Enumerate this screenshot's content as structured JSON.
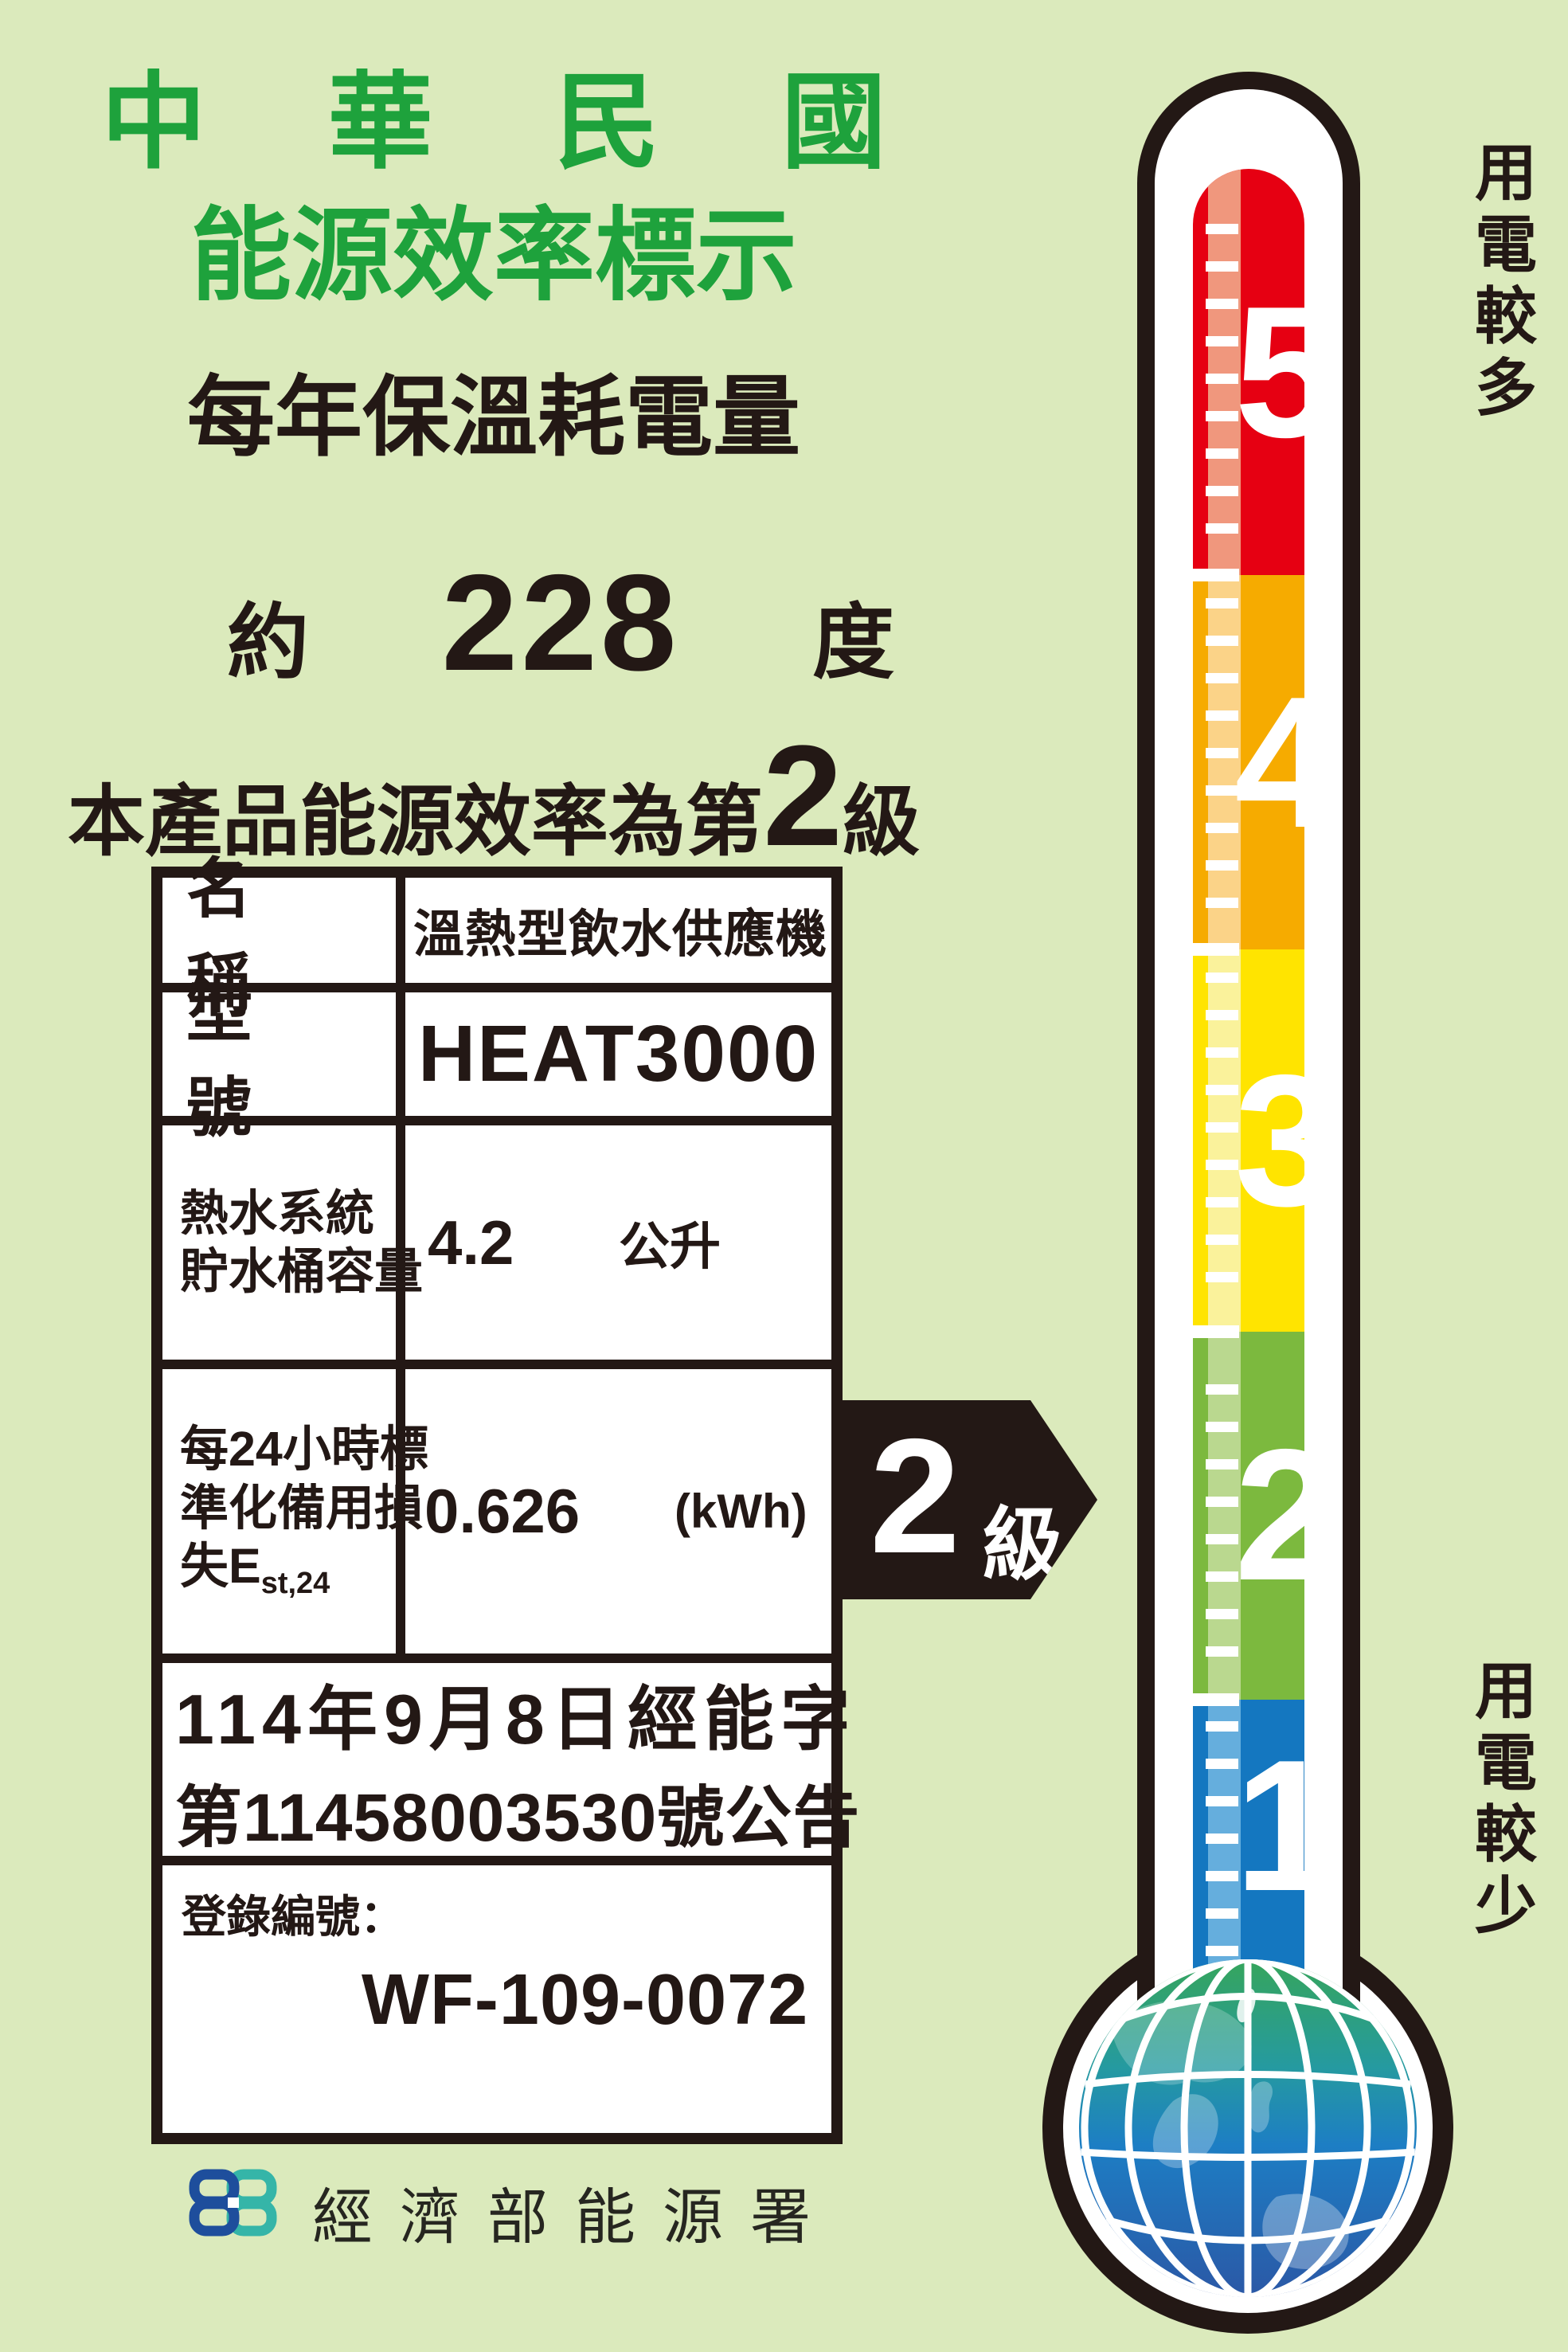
{
  "header": {
    "title_line1": "中 華 民 國",
    "title_line2": "能源效率標示",
    "subtitle": "每年保溫耗電量",
    "consumption_prefix": "約",
    "consumption_value": "228",
    "consumption_unit": "度",
    "rating_prefix": "本產品能源效率為第",
    "rating_value": "2",
    "rating_suffix": "級"
  },
  "table": {
    "rows": [
      {
        "label": "名　稱",
        "value": "溫熱型飲水供應機"
      },
      {
        "label": "型　號",
        "value": "HEAT3000"
      },
      {
        "label_line1": "熱水系統",
        "label_line2": "貯水桶容量",
        "value": "4.2",
        "unit": "公升"
      },
      {
        "label_line1": "每24小時標",
        "label_line2": "準化備用損",
        "label_line3_main": "失E",
        "label_line3_sub": "st,24",
        "value": "0.626",
        "unit": "(kWh)"
      }
    ],
    "announcement_line1": "114年9月8日經能字",
    "announcement_line2": "第11458003530號公告",
    "registration_label": "登錄編號：",
    "registration_value": "WF-109-0072"
  },
  "grade_arrow": {
    "value": "2",
    "suffix": "級"
  },
  "thermometer": {
    "scale_top_label": "用電較多",
    "scale_bottom_label": "用電較少",
    "levels": [
      {
        "value": "5",
        "color": "#e60012",
        "tint": "#f0977d"
      },
      {
        "value": "4",
        "color": "#f6ab00",
        "tint": "#fbd388"
      },
      {
        "value": "3",
        "color": "#ffe400",
        "tint": "#faf29b"
      },
      {
        "value": "2",
        "color": "#7cb93e",
        "tint": "#bad88f"
      },
      {
        "value": "1",
        "color": "#1477c0",
        "tint": "#65aedd"
      }
    ]
  },
  "footer": {
    "agency": "經濟部能源署"
  },
  "colors": {
    "background": "#dbeabc",
    "title_green": "#1ea23c",
    "ink": "#231815",
    "logo_blue": "#1e4e9c",
    "logo_teal": "#35b5a8",
    "globe_top": "#36a55c",
    "globe_bottom": "#2b58a6"
  }
}
